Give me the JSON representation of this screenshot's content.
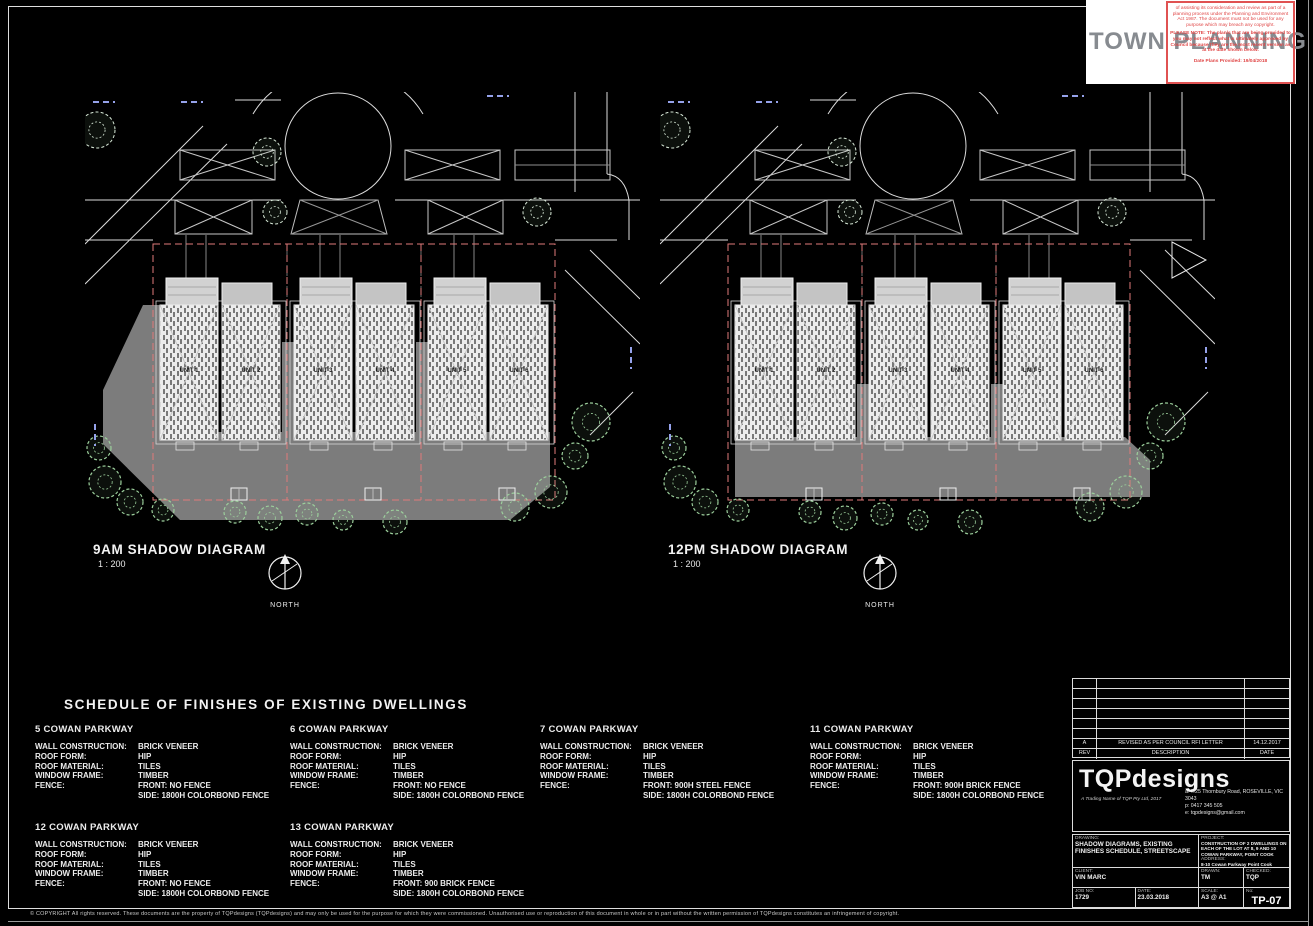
{
  "colors": {
    "line_white": "#e8e8e8",
    "shadow_grey": "#7c7c7c",
    "boundary_red": "#e07a7a",
    "tree_green": "#9ccf9c",
    "tree_pale": "#d9ead9",
    "blue_mark": "#95a2ea"
  },
  "stamp": {
    "title": "TOWN PLANNING",
    "disclaimer": "of assisting its consideration and review as part of a planning process under the Planning and Environment Act 1987. The document must not be used for any purpose which may breach any copyright.",
    "note": "PLEASE NOTE: The plan/s that are being provided to you may not reflect what is ultimately approved by Council because they are the most recent version as at the date shown below.",
    "date_line": "Date Plans Provided: 19/04/2018"
  },
  "diagrams": [
    {
      "title": "9AM SHADOW DIAGRAM",
      "scale": "1 : 200",
      "north": "NORTH",
      "units": [
        "UNIT 1",
        "UNIT 2",
        "UNIT 3",
        "UNIT 4",
        "UNIT 5",
        "UNIT 6"
      ]
    },
    {
      "title": "12PM SHADOW DIAGRAM",
      "scale": "1 : 200",
      "north": "NORTH",
      "units": [
        "UNIT 1",
        "UNIT 2",
        "UNIT 3",
        "UNIT 4",
        "UNIT 5",
        "UNIT 6"
      ]
    }
  ],
  "schedule": {
    "title": "SCHEDULE OF FINISHES OF EXISTING DWELLINGS",
    "labels": {
      "wall": "WALL CONSTRUCTION:",
      "roof_form": "ROOF FORM:",
      "roof_material": "ROOF MATERIAL:",
      "window": "WINDOW FRAME:",
      "fence": "FENCE:"
    },
    "entries": [
      {
        "address": "5 COWAN PARKWAY",
        "wall": "BRICK VENEER",
        "roof_form": "HIP",
        "roof_material": "TILES",
        "window": "TIMBER",
        "fence_front": "FRONT: NO FENCE",
        "fence_side": "SIDE: 1800H COLORBOND FENCE"
      },
      {
        "address": "6 COWAN PARKWAY",
        "wall": "BRICK VENEER",
        "roof_form": "HIP",
        "roof_material": "TILES",
        "window": "TIMBER",
        "fence_front": "FRONT: NO FENCE",
        "fence_side": "SIDE: 1800H COLORBOND FENCE"
      },
      {
        "address": "7 COWAN PARKWAY",
        "wall": "BRICK VENEER",
        "roof_form": "HIP",
        "roof_material": "TILES",
        "window": "TIMBER",
        "fence_front": "FRONT: 900H STEEL FENCE",
        "fence_side": "SIDE: 1800H COLORBOND FENCE"
      },
      {
        "address": "11 COWAN PARKWAY",
        "wall": "BRICK VENEER",
        "roof_form": "HIP",
        "roof_material": "TILES",
        "window": "TIMBER",
        "fence_front": "FRONT: 900H BRICK FENCE",
        "fence_side": "SIDE: 1800H COLORBOND FENCE"
      },
      {
        "address": "12 COWAN PARKWAY",
        "wall": "BRICK VENEER",
        "roof_form": "HIP",
        "roof_material": "TILES",
        "window": "TIMBER",
        "fence_front": "FRONT: NO FENCE",
        "fence_side": "SIDE: 1800H COLORBOND FENCE"
      },
      {
        "address": "13 COWAN PARKWAY",
        "wall": "BRICK VENEER",
        "roof_form": "HIP",
        "roof_material": "TILES",
        "window": "TIMBER",
        "fence_front": "FRONT: 900 BRICK FENCE",
        "fence_side": "SIDE: 1800H COLORBOND FENCE"
      }
    ]
  },
  "titleblock": {
    "revision": {
      "rev": "A",
      "description": "REVISED AS PER COUNCIL RFI LETTER",
      "date": "14.12.2017"
    },
    "rev_header": {
      "rev": "REV",
      "description": "DESCRIPTION",
      "date": "DATE"
    },
    "logo": "TQPdesigns",
    "tagline": "A Trading Name of TQP Pty Ltd, 2017",
    "contact_a": "a: 7/25 Thornbury Road, ROSEVILLE, VIC 3043",
    "contact_p": "p: 0417 345 505",
    "contact_e": "e: tqpdesigns@gmail.com",
    "labels": {
      "drawing": "DRAWING:",
      "client": "CLIENT:",
      "job": "JOB NO:",
      "date": "DATE:",
      "project": "PROJECT:",
      "address": "ADDRESS:",
      "drawn": "DRAWN:",
      "checked": "CHECKED:",
      "scale": "SCALE:",
      "number": "No:"
    },
    "drawing": "SHADOW DIAGRAMS, EXISTING FINISHES SCHEDULE, STREETSCAPE",
    "client": "VIN MARC",
    "job_no": "1729",
    "date": "23.03.2018",
    "project": "CONSTRUCTION OF 2 DWELLINGS ON EACH OF THE LOT AT 8, 9 AND 10 COWAN PARKWAY, POINT COOK",
    "address": "8-10 Cowan Parkway Point Cook",
    "drawn": "TM",
    "checked": "TQP",
    "scale": "A3 @ A1",
    "sheet": "TP-07"
  },
  "footer": {
    "copyright": "© COPYRIGHT   All rights reserved. These documents are the property of TQPdesigns (TQPdesigns) and may only be used for the purpose for which they were commissioned. Unauthorised use or reproduction of this document in whole or in part without the written permission of TQPdesigns constitutes an infringement of copyright."
  }
}
